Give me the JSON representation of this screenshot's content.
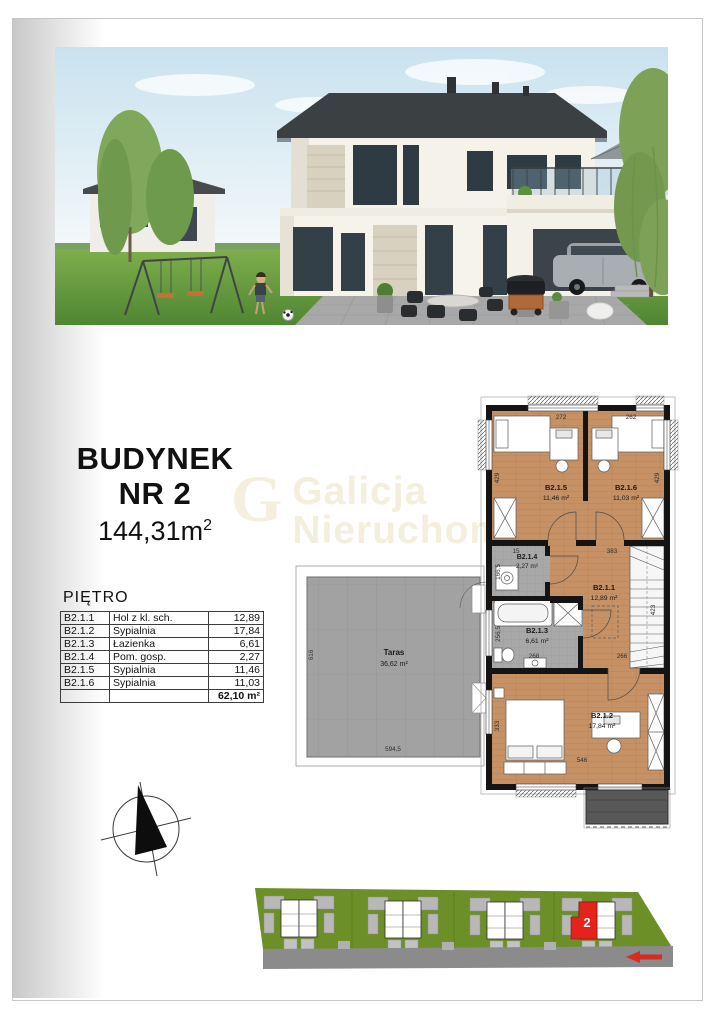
{
  "title_block": {
    "line1": "BUDYNEK",
    "line2": "NR 2",
    "area_value": "144,31m",
    "area_sup": "2"
  },
  "watermark": {
    "logo": "G",
    "line1": "Galicja",
    "line2": "Nieruchomości"
  },
  "rooms_table": {
    "header": "PIĘTRO",
    "rows": [
      {
        "code": "B2.1.1",
        "name": "Hol z kl. sch.",
        "area": "12,89"
      },
      {
        "code": "B2.1.2",
        "name": "Sypialnia",
        "area": "17,84"
      },
      {
        "code": "B2.1.3",
        "name": "Łazienka",
        "area": "6,61"
      },
      {
        "code": "B2.1.4",
        "name": "Pom. gosp.",
        "area": "2,27"
      },
      {
        "code": "B2.1.5",
        "name": "Sypialnia",
        "area": "11,46"
      },
      {
        "code": "B2.1.6",
        "name": "Sypialnia",
        "area": "11,03"
      }
    ],
    "total": "62,10 m²"
  },
  "floor_plan": {
    "rooms": {
      "b211": {
        "code": "B2.1.1",
        "area": "12,89 m²"
      },
      "b212": {
        "code": "B2.1.2",
        "area": "17,84 m²"
      },
      "b213": {
        "code": "B2.1.3",
        "area": "6,61 m²"
      },
      "b214": {
        "code": "B2.1.4",
        "area": "2,27 m²"
      },
      "b215": {
        "code": "B2.1.5",
        "area": "11,46 m²"
      },
      "b216": {
        "code": "B2.1.6",
        "area": "11,03 m²"
      },
      "taras": {
        "code": "Taras",
        "area": "36,62 m²"
      }
    },
    "dimensions": {
      "top_left": "272",
      "top_right": "262",
      "left_upper": "429",
      "right_upper": "429",
      "util_top": "15",
      "hall_top": "383",
      "util_left": "166,5",
      "bath_left": "256,5",
      "bath_bottom": "268",
      "hall_bottom": "266",
      "stairs_right": "423",
      "bed2_left": "333",
      "bed2_bottom": "546",
      "terrace_left": "616",
      "terrace_bottom": "594,5"
    }
  },
  "site_plan": {
    "highlighted_unit": "2"
  },
  "colors": {
    "highlight_red": "#e3231c",
    "site_green": "#6d8f28",
    "road_gray": "#8b8b8b",
    "floor_wood": "#c69164",
    "tile_gray": "#a8a8a8"
  }
}
